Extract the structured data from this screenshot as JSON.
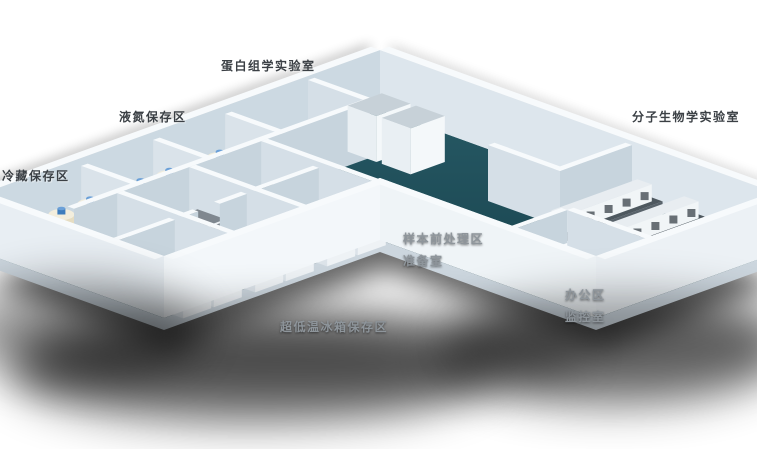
{
  "scene": {
    "type": "isometric-laboratory-floorplan",
    "background": "#ffffff",
    "colors": {
      "floor_top": "#2a5e6a",
      "floor_bottom": "#16404a",
      "wall_back_face": "#ccd9e2",
      "wall_back_face2": "#dde6ed",
      "wall_inner_u": "#c7d4dd",
      "wall_inner_v": "#d5dfe7",
      "wall_stub": "#dae3ea",
      "wall_top": "#f7fafc",
      "wall_front_left_end": "#e8eef3",
      "wall_front_left": "#f3f7fa",
      "wall_front_right": "#eff4f7",
      "wall_right_end": "#ecf1f5",
      "slab": "#ccd6de",
      "freezer_top": "#7f878f",
      "freezer_left": "#dce3e9",
      "freezer_front": "#eef2f5",
      "cabinet_top": "#c7d1d8",
      "cabinet_left": "#e9eff3",
      "cabinet_front": "#f4f8fa",
      "tank_body": "#e6ddc2",
      "tank_body_shade": "#d8cfb2",
      "tank_highlight": "#f6f1e2",
      "tank_top": "#f3eedd",
      "tank_cap": "#3e7dbd",
      "tank_cap_top": "#6ba0d8",
      "bench_top": "#4e585f",
      "bench_slab_front": "#59636b",
      "equip_dark": "#39424a",
      "shadow": "#000000",
      "label_dark": "#3b4045",
      "label_light": "#8e959b"
    },
    "labels": [
      {
        "id": "proteomics-lab",
        "text": "蛋白组学实验室",
        "tone": "dark"
      },
      {
        "id": "liquid-nitrogen-area",
        "text": "液氮保存区",
        "tone": "dark"
      },
      {
        "id": "cold-storage-area",
        "text": "冷藏保存区",
        "tone": "dark"
      },
      {
        "id": "molecular-biology-lab",
        "text": "分子生物学实验室",
        "tone": "dark"
      },
      {
        "id": "sample-pretreatment-area",
        "text": "样本前处理区",
        "tone": "light"
      },
      {
        "id": "preparation-room",
        "text": "准备室",
        "tone": "light"
      },
      {
        "id": "office-area",
        "text": "办公区",
        "tone": "light"
      },
      {
        "id": "monitoring-room",
        "text": "监控室",
        "tone": "light"
      },
      {
        "id": "ult-freezer-area",
        "text": "超低温冰箱保存区",
        "tone": "light"
      }
    ]
  }
}
